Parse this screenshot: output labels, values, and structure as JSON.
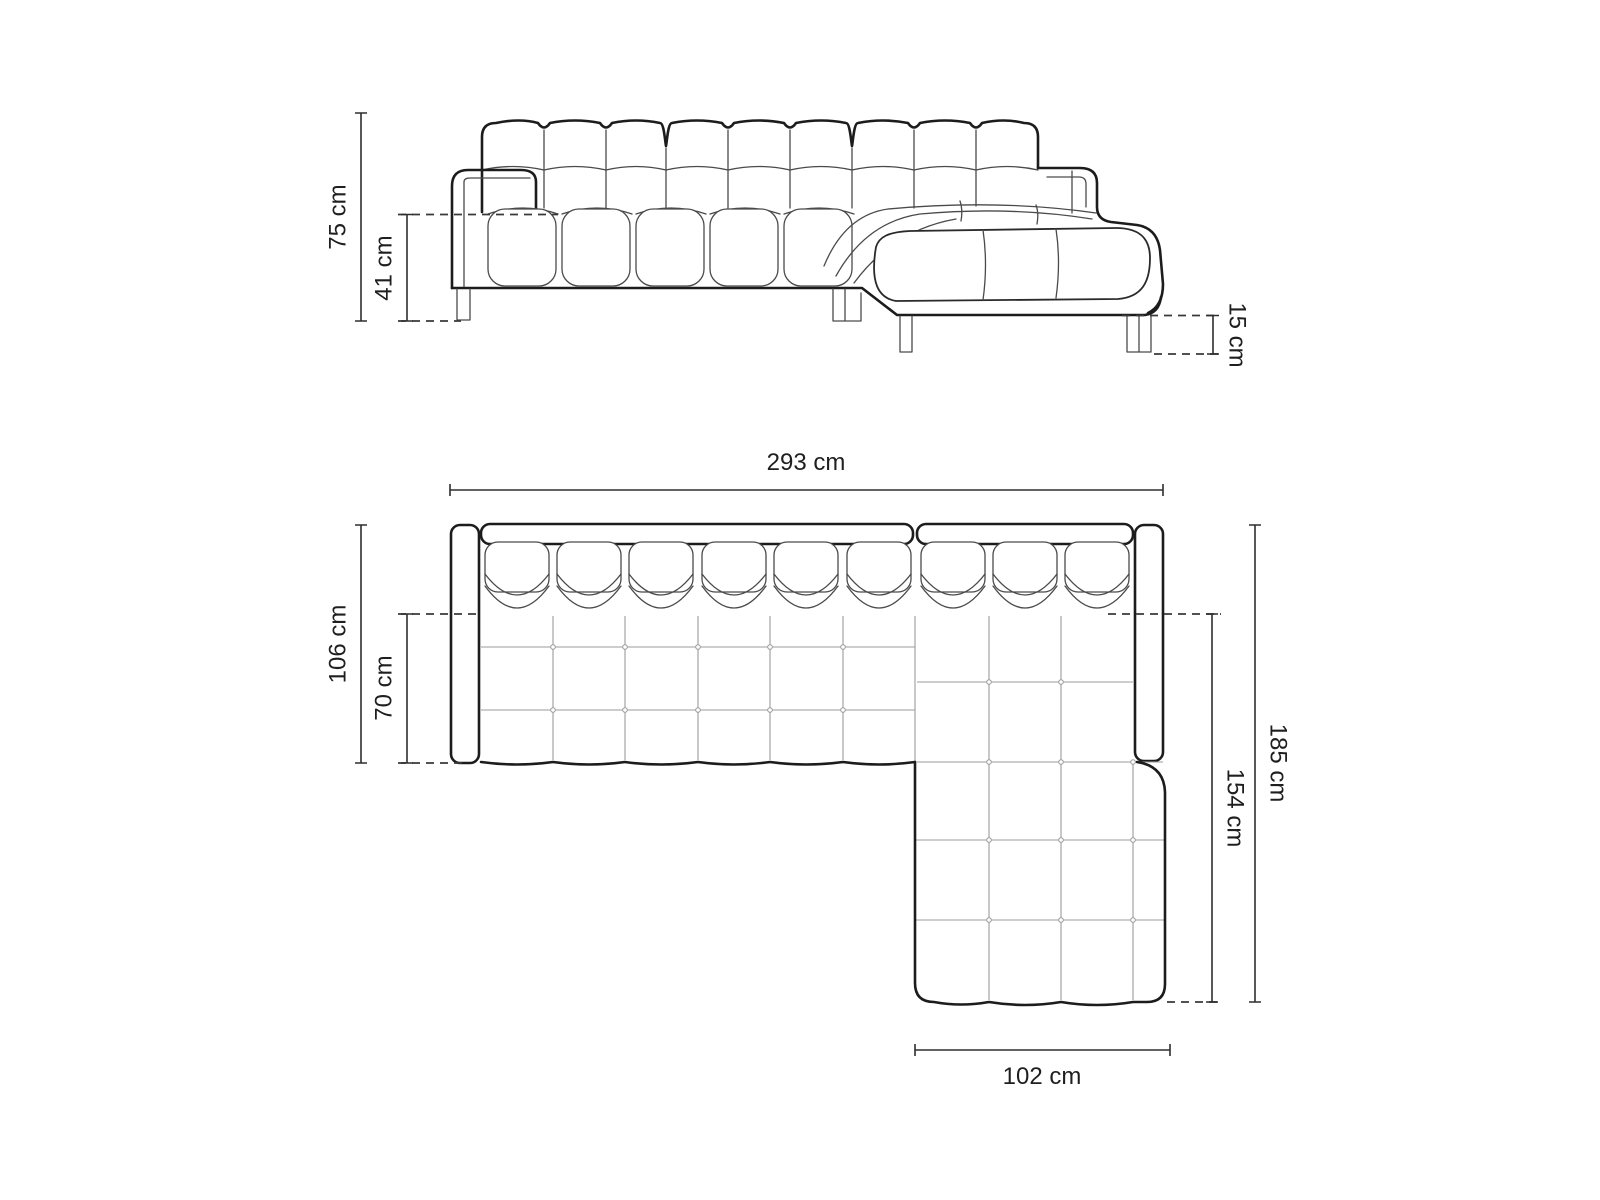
{
  "diagram": {
    "type": "furniture dimension drawing",
    "subject": "corner sofa with chaise, front elevation and top plan",
    "background_color": "#ffffff",
    "outline_color": "#1c1c1c",
    "dimension_line_color": "#2e2e2e",
    "grid_line_color": "#9b9b9b",
    "text_color": "#1f1f1f"
  },
  "front_view": {
    "dimensions": {
      "total_height": "75 cm",
      "seat_height": "41 cm",
      "leg_height": "15 cm"
    }
  },
  "top_view": {
    "dimensions": {
      "total_width": "293 cm",
      "total_depth": "106 cm",
      "seat_depth": "70 cm",
      "total_length_side": "185 cm",
      "chaise_length": "154 cm",
      "chaise_width": "102 cm"
    }
  }
}
